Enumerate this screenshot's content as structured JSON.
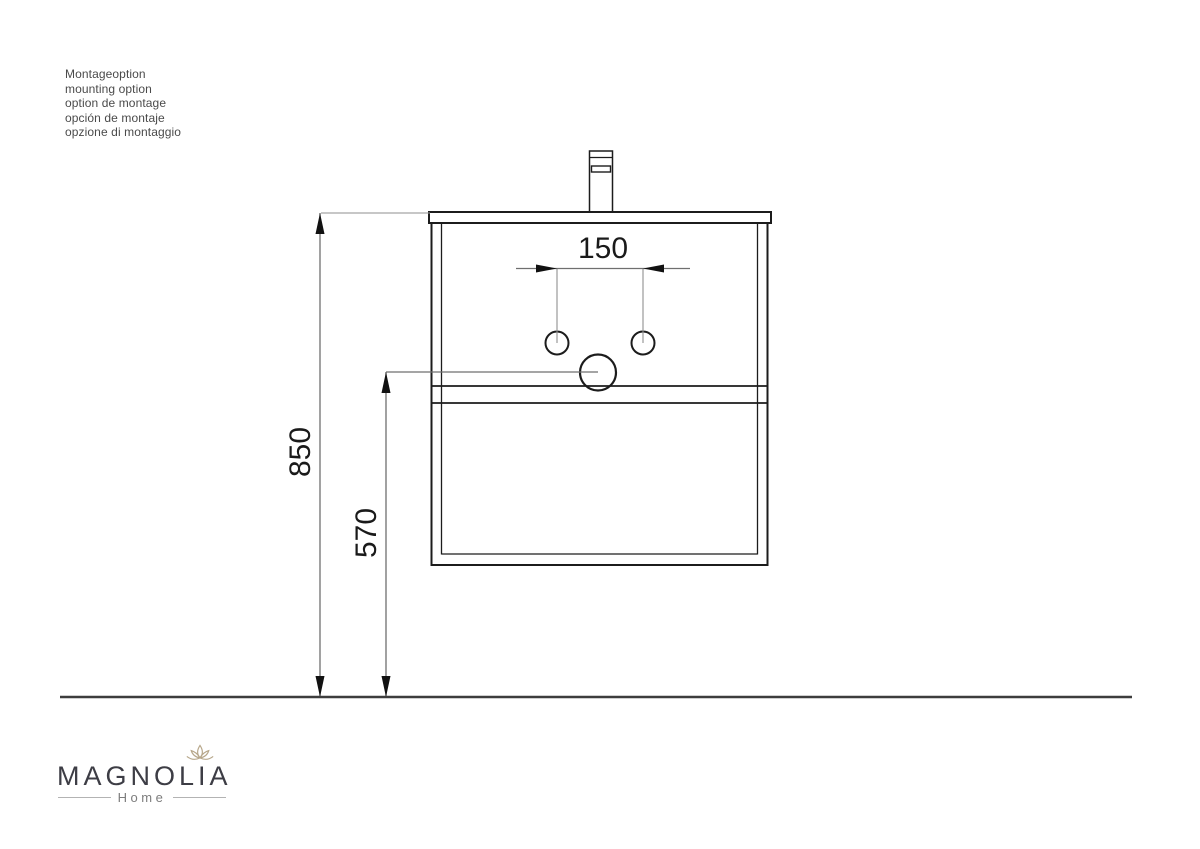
{
  "notes": {
    "lines": [
      "Montageoption",
      "mounting option",
      "option de montage",
      "opción de montaje",
      "opzione di montaggio"
    ]
  },
  "drawing": {
    "type": "technical-dimension-drawing",
    "subject": "wall-mounted washbasin vanity, front view",
    "dim_hole_spacing": "150",
    "dim_floor_to_top": "850",
    "dim_floor_to_drain": "570"
  },
  "logo": {
    "brand": "MAGNOLIA",
    "subtitle": "Home",
    "icon": "lotus-flower-icon",
    "brand_color": "#3d3d45",
    "flower_color": "#b7a78a"
  },
  "colors": {
    "drawing_line": "#1c1c1c",
    "dimension_line": "#6f6f6f",
    "floor_line": "#3d3d3d",
    "background": "#ffffff"
  }
}
